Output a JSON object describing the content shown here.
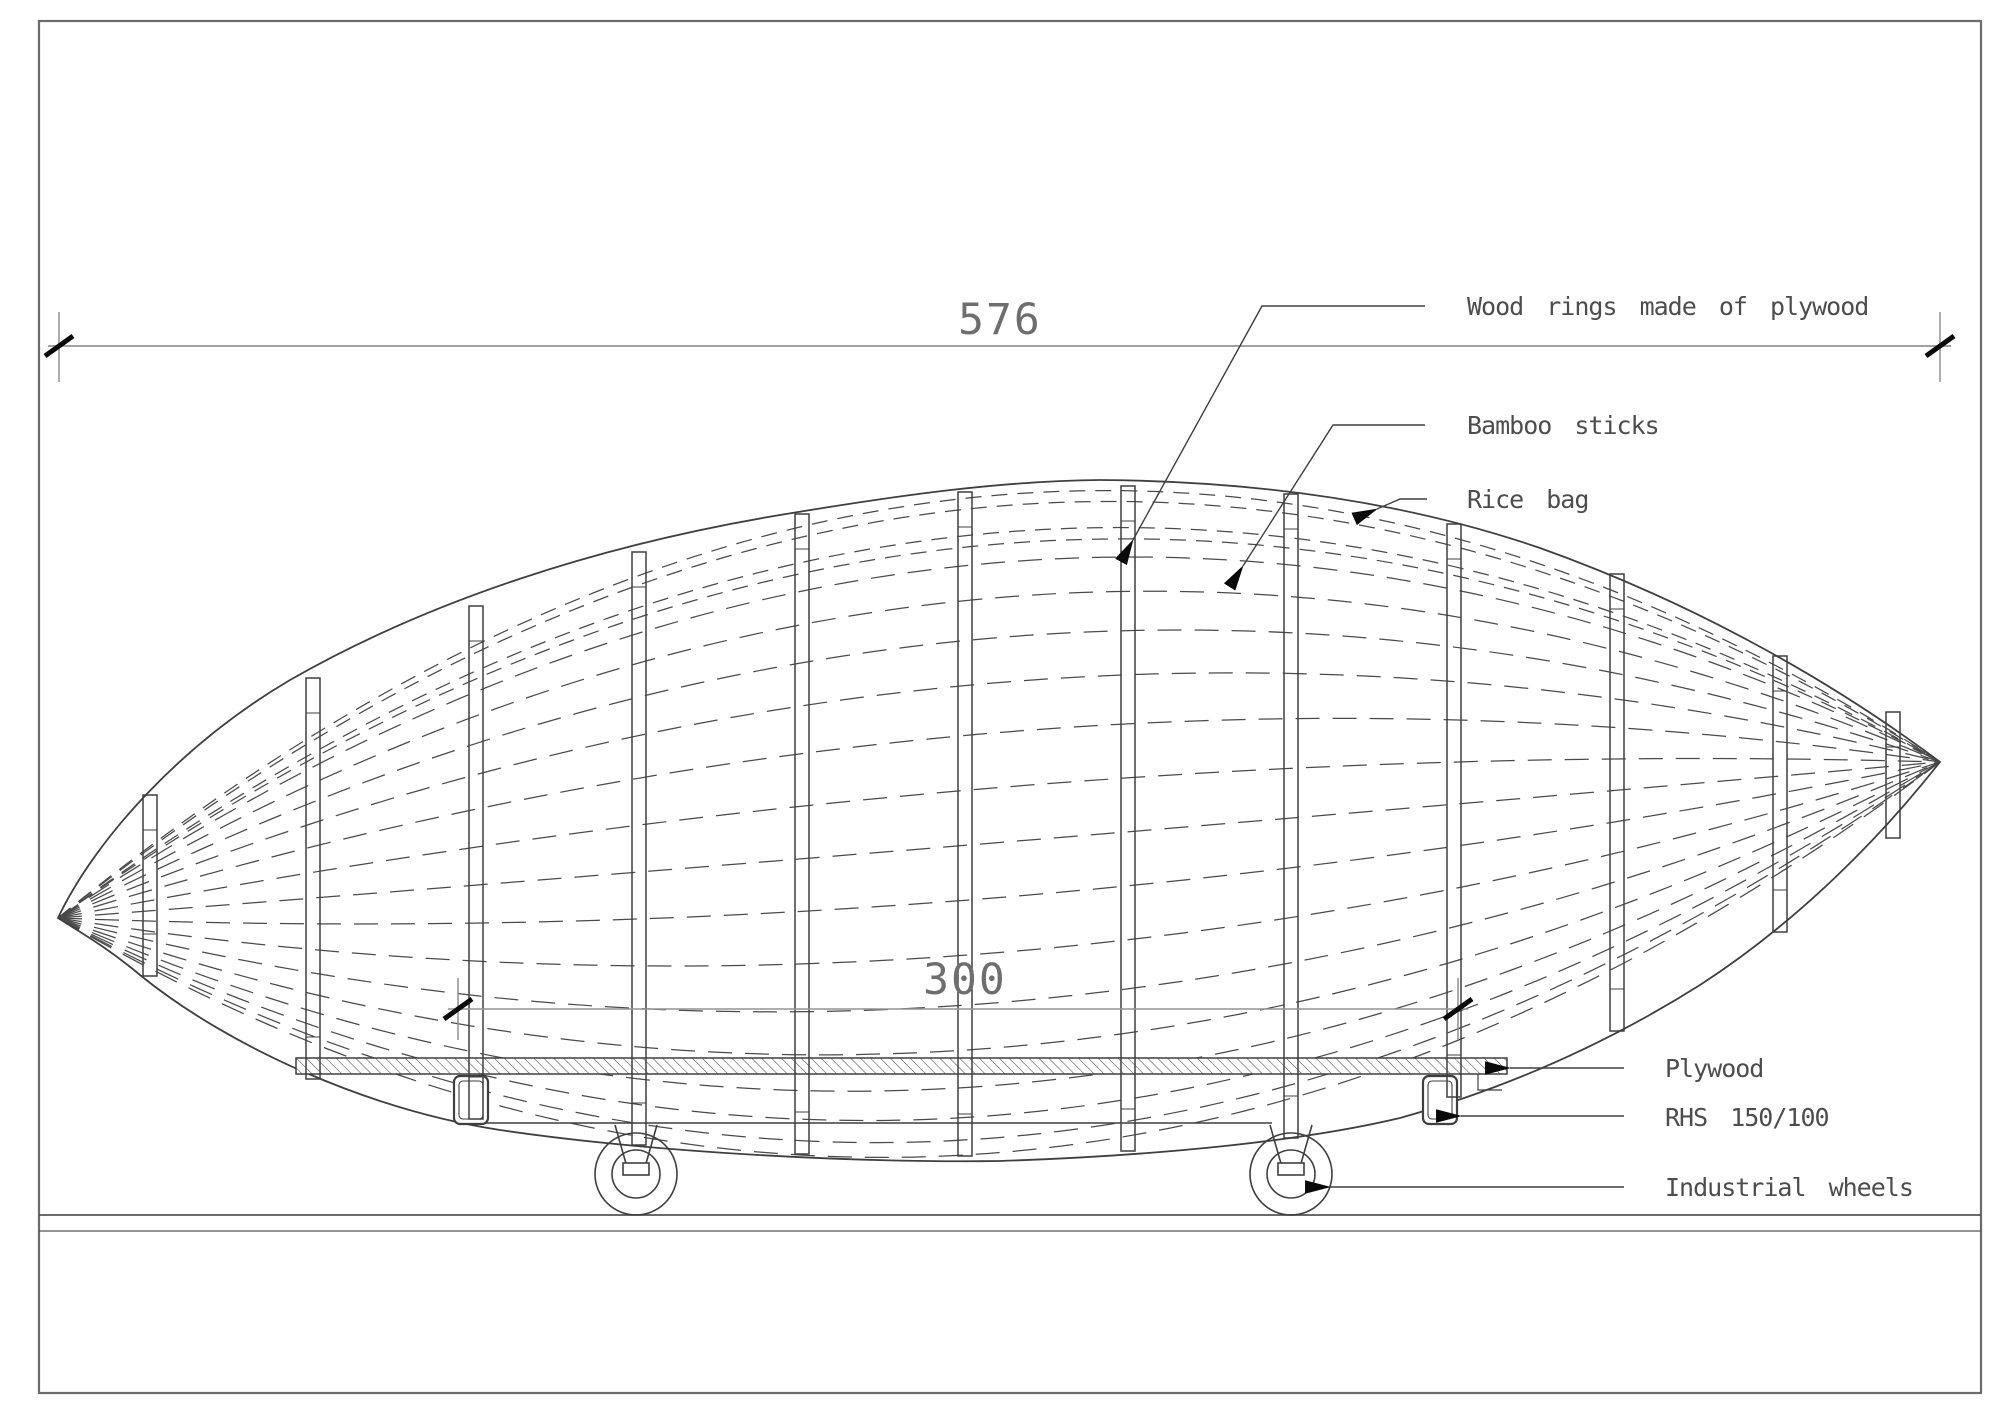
{
  "drawing": {
    "title": "Airship / zeppelin sculpture construction drawing, side elevation",
    "dimensions": {
      "overall_length": "576",
      "platform_length": "300"
    },
    "annotations": {
      "wood_rings": "Wood rings made of plywood",
      "bamboo": "Bamboo sticks",
      "rice_bag": "Rice bag",
      "plywood": "Plywood",
      "rhs": "RHS 150/100",
      "wheels": "Industrial wheels"
    },
    "colors": {
      "line": "#3f3f3f",
      "dashed": "#4a4a4a",
      "dimension": "#949494",
      "tick": "#0a0a0a",
      "text": "#4d4d4d",
      "frame": "#6b6b6b",
      "background": "#ffffff"
    }
  }
}
